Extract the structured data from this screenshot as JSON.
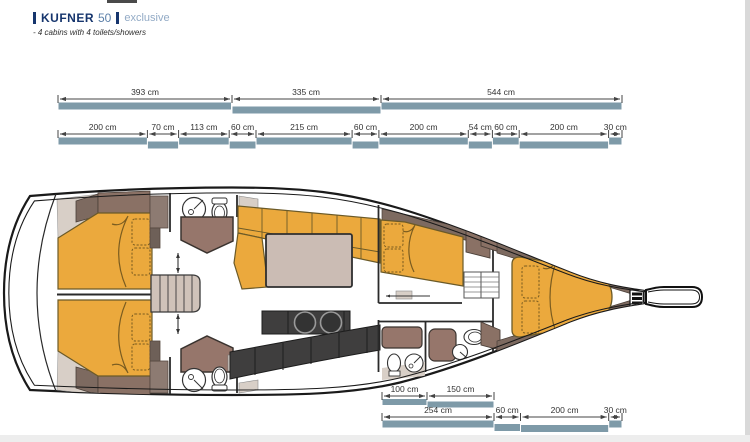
{
  "header": {
    "brand": "KUFNER",
    "model": "50",
    "edition": "exclusive",
    "subtitle": "- 4 cabins with 4 toilets/showers"
  },
  "colors": {
    "navy": "#16356d",
    "model_blue": "#5b7fa8",
    "edition_blue": "#93abc6",
    "dim_bar": "#7e9aa8",
    "furniture_orange": "#eba93d",
    "wood_brown": "#96766b",
    "trim_brown": "#7d6a60",
    "locker_brown": "#8a7165",
    "counter_dark": "#3f3e3e",
    "beige": "#d8cfc7",
    "table_beige": "#cbbcb4"
  },
  "dimensions": {
    "unit": "cm",
    "top_sections": {
      "segments": [
        {
          "value": 393,
          "label": "393 cm"
        },
        {
          "value": 335,
          "label": "335 cm"
        },
        {
          "value": 544,
          "label": "544 cm"
        }
      ]
    },
    "top_detail": {
      "segments": [
        {
          "value": 200,
          "label": "200 cm"
        },
        {
          "value": 70,
          "label": "70 cm"
        },
        {
          "value": 113,
          "label": "113 cm"
        },
        {
          "value": 60,
          "label": "60 cm"
        },
        {
          "value": 215,
          "label": "215 cm"
        },
        {
          "value": 60,
          "label": "60 cm"
        },
        {
          "value": 200,
          "label": "200 cm"
        },
        {
          "value": 54,
          "label": "54 cm"
        },
        {
          "value": 60,
          "label": "60 cm"
        },
        {
          "value": 200,
          "label": "200 cm"
        },
        {
          "value": 30,
          "label": "30 cm"
        }
      ]
    },
    "bottom_upper": {
      "segments": [
        {
          "value": 100,
          "label": "100 cm"
        },
        {
          "value": 150,
          "label": "150 cm"
        }
      ]
    },
    "bottom_detail": {
      "segments": [
        {
          "value": 254,
          "label": "254 cm"
        },
        {
          "value": 60,
          "label": "60 cm"
        },
        {
          "value": 200,
          "label": "200 cm"
        },
        {
          "value": 30,
          "label": "30 cm"
        }
      ]
    }
  }
}
